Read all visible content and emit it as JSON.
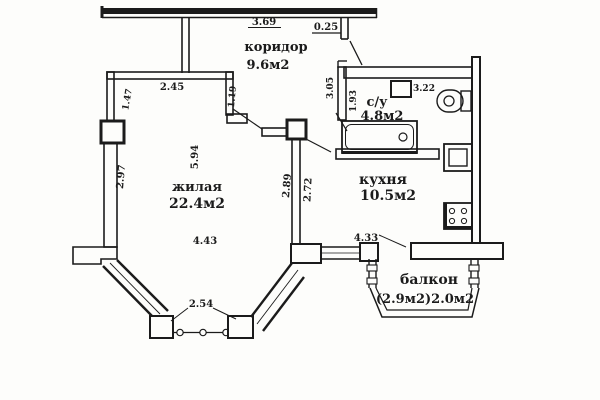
{
  "document": {
    "type": "apartment floor plan"
  },
  "rooms": {
    "corridor": {
      "name": "коридор",
      "area": "9.6м2"
    },
    "bathroom": {
      "name": "с/у",
      "area": "4.8м2"
    },
    "kitchen": {
      "name": "кухня",
      "area": "10.5м2"
    },
    "living": {
      "name": "жилая",
      "area": "22.4м2"
    },
    "balcony": {
      "name": "балкон",
      "area": "(2.9м2)2.0м2"
    }
  },
  "dimensions": {
    "top_width": "3.69",
    "entry_stub": "0.25",
    "bathroom_height": "3.05",
    "bathroom_width": "3.22",
    "bathroom_inner": "1.93",
    "niche_width": "2.45",
    "niche_left": "1.47",
    "niche_right": "1.19",
    "living_height": "5.94",
    "living_wall_left": "2.89",
    "living_wall_right": "2.72",
    "left_wall": "2.97",
    "bay_width": "4.43",
    "bay_window": "2.54",
    "kitchen_window": "4.33"
  },
  "colors": {
    "line": "#1b1b1b",
    "background": "#fdfdfb"
  }
}
